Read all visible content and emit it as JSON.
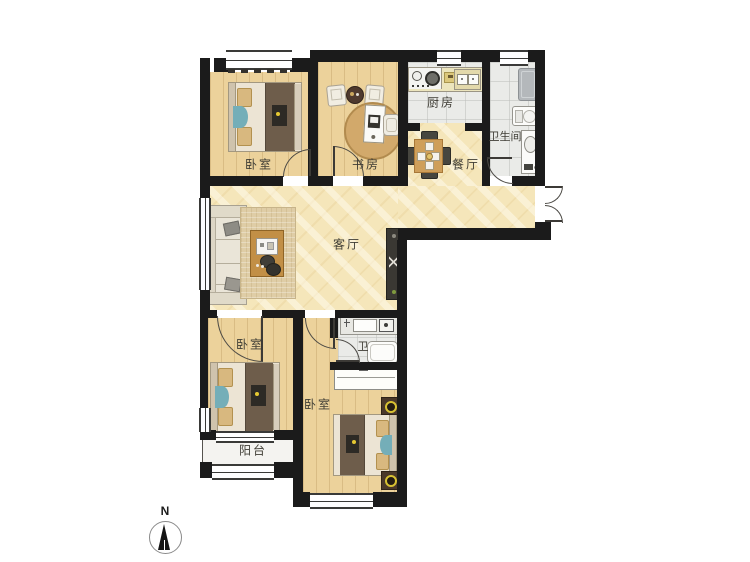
{
  "plan": {
    "compass": {
      "label": "N"
    },
    "rooms": [
      {
        "id": "bedroom-top-left",
        "label": "卧室"
      },
      {
        "id": "study",
        "label": "书房"
      },
      {
        "id": "kitchen",
        "label": "厨房"
      },
      {
        "id": "bathroom-main",
        "label": "卫生间"
      },
      {
        "id": "dining-room",
        "label": "餐厅"
      },
      {
        "id": "living-room",
        "label": "客厅"
      },
      {
        "id": "bedroom-lower-left",
        "label": "卧室"
      },
      {
        "id": "bathroom-small",
        "label": "卫"
      },
      {
        "id": "bedroom-bottom",
        "label": "卧室"
      },
      {
        "id": "balcony",
        "label": "阳台"
      }
    ],
    "colors": {
      "wall": "#1b1b1b",
      "wood_floor": "#ecd29b",
      "marble_floor": "#f5e6ba",
      "tile_floor": "#eaebe8",
      "balcony_floor": "#f4f3f0",
      "accent_teal": "#74aeb8",
      "lamp_yellow": "#d7c133",
      "blanket_dark": "#6e5d4b",
      "table_wood": "#cf9f5a"
    }
  }
}
